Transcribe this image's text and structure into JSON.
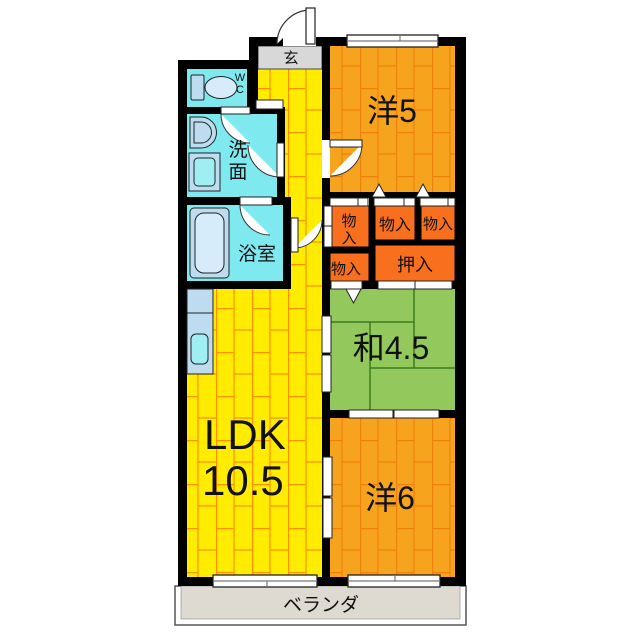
{
  "floorplan": {
    "entry": {
      "label": "玄"
    },
    "wc": {
      "line1": "W",
      "line2": "C"
    },
    "washroom": {
      "char1": "洗",
      "char2": "面"
    },
    "bathroom": {
      "label": "浴室"
    },
    "western5": {
      "label": "洋5"
    },
    "closet_tall": {
      "char1": "物",
      "char2": "入"
    },
    "closet_mid": {
      "label": "物入"
    },
    "closet_right": {
      "label": "物入"
    },
    "closet_lower": {
      "label": "物入"
    },
    "oshiire": {
      "label": "押入"
    },
    "japanese": {
      "label": "和4.5"
    },
    "ldk": {
      "name": "LDK",
      "size": "10.5"
    },
    "western6": {
      "label": "洋6"
    },
    "veranda": {
      "label": "ベランダ"
    }
  },
  "colors": {
    "wall": "#000000",
    "ldk_floor": "#FFEC00",
    "ldk_joint": "#FF9000",
    "western_floor": "#F6A41E",
    "western_joint": "#EE7D0A",
    "tatami_floor": "#93C85C",
    "tatami_joint": "#3E7A1E",
    "closet": "#F8701E",
    "wet_room": "#7FE9F0",
    "entry_floor": "#D8D8D8",
    "veranda_floor": "#DEDAD2",
    "fixture": "#BDDCF0",
    "fixture_inner": "#9FEFF2",
    "fixture_light": "#D6ECFA",
    "opening": "#FFFFFF"
  }
}
